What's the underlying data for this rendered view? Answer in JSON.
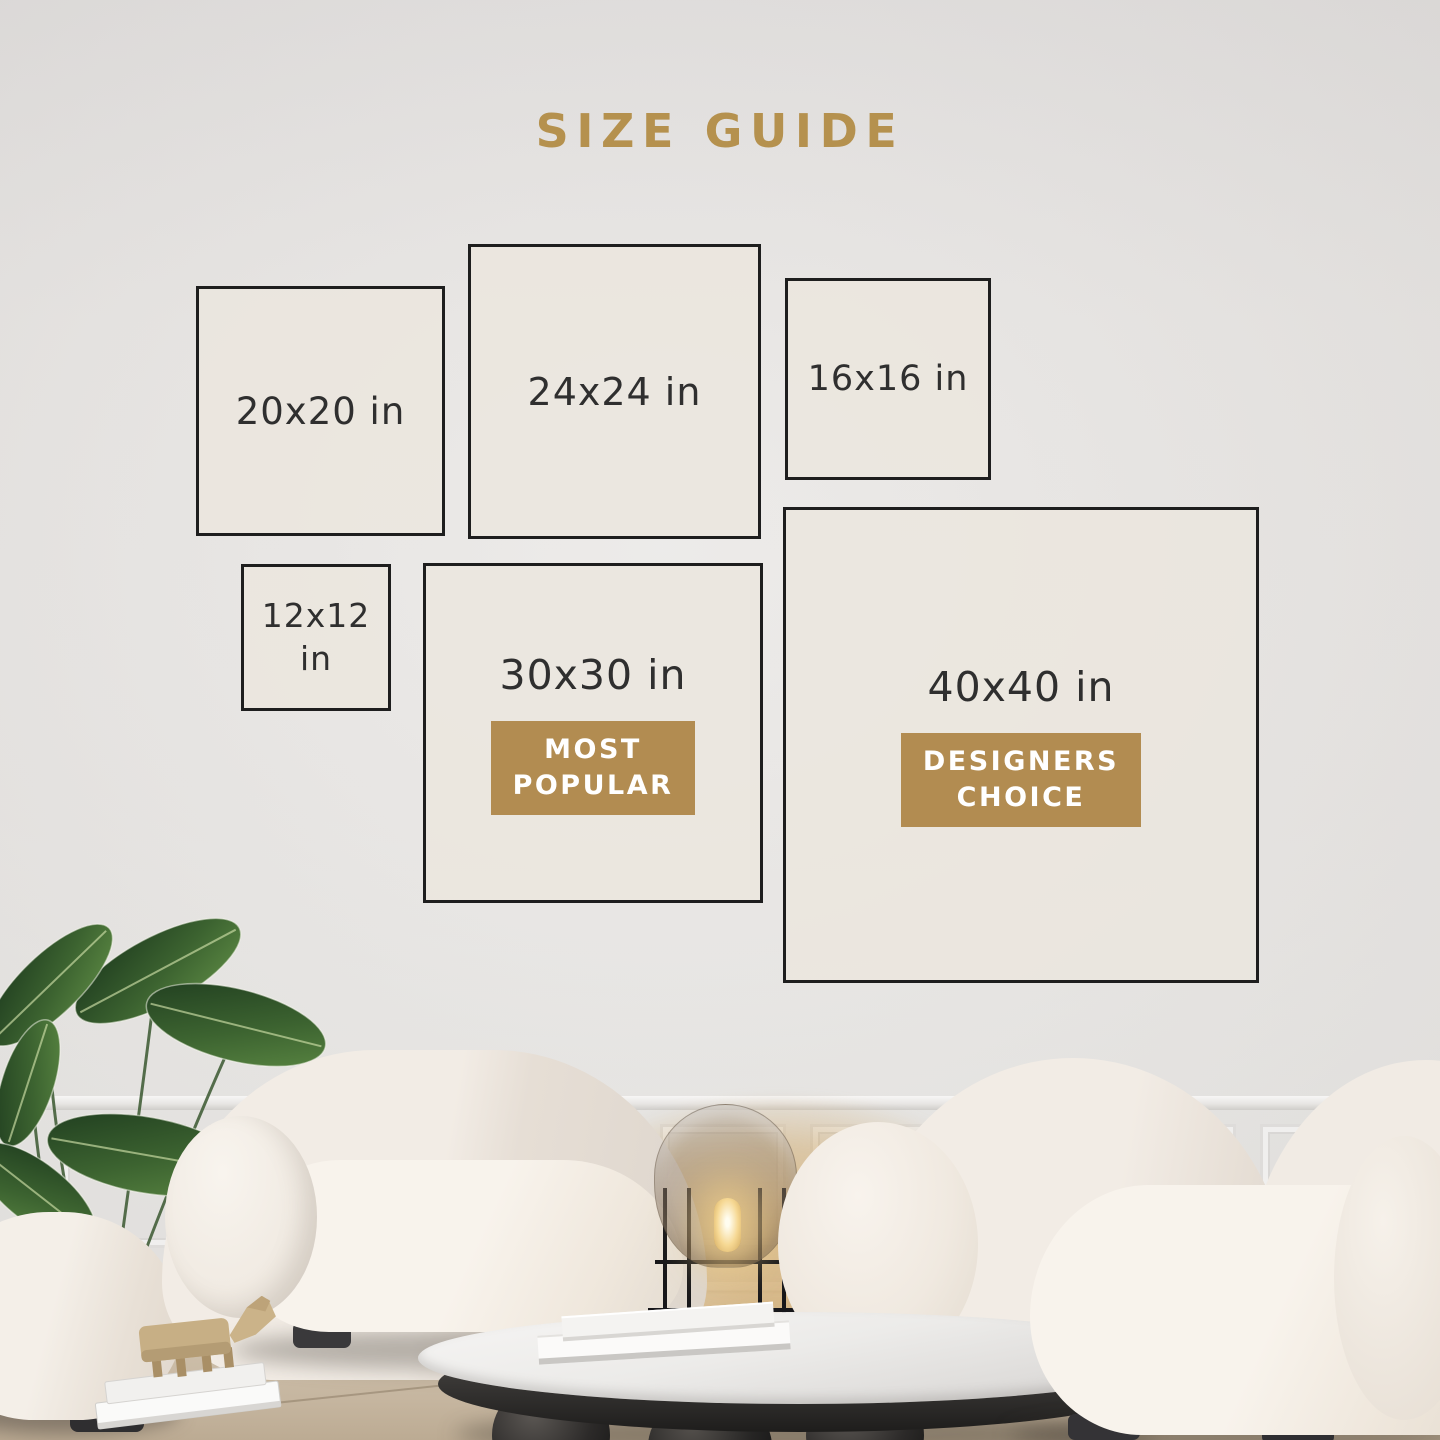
{
  "page": {
    "title": "SIZE GUIDE"
  },
  "colors": {
    "accent_gold": "#b5914e",
    "badge_gold": "#b28c51",
    "outline": "#1e1e1e",
    "label_text": "#2f2f2f",
    "badge_text": "#ffffff",
    "box_fill": "#eae5de"
  },
  "size_boxes": [
    {
      "label": "20x20 in"
    },
    {
      "label": "24x24 in"
    },
    {
      "label": "16x16 in"
    },
    {
      "label": "12x12 in"
    },
    {
      "label": "30x30 in",
      "badge_line1": "MOST",
      "badge_line2": "POPULAR"
    },
    {
      "label": "40x40 in",
      "badge_line1": "DESIGNERS",
      "badge_line2": "CHOICE"
    }
  ]
}
